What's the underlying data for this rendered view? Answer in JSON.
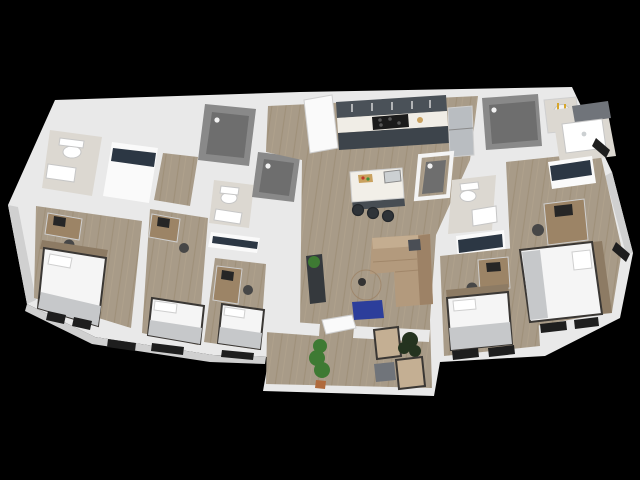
{
  "image": {
    "alt": "3D isometric rendering of a five bedroom, four bathroom apartment floor plan on a black background. Center has a kitchen with dark cabinets and an island with three stools, a living room with a tan sectional sofa, round coffee table and blue rug, and a lower entry lounge with two armchairs, an ottoman and plants. Left and right wings each hold bedrooms with beds and desks, bathrooms, walk-in showers and closets."
  },
  "scene": {
    "type": "3d-floorplan-rendering",
    "rooms": [
      "kitchen",
      "living-room",
      "entry-lounge",
      "bedroom-1",
      "bedroom-2",
      "bedroom-3",
      "bedroom-4",
      "bedroom-5",
      "bathroom-1",
      "bathroom-2",
      "bathroom-3",
      "bathroom-4",
      "shower-stalls",
      "closets",
      "laundry-water-heater"
    ],
    "furniture": [
      "bed-x5",
      "desk-x5",
      "desk-chair-x5",
      "sectional-sofa",
      "round-coffee-table",
      "media-console",
      "blue-rug",
      "kitchen-island",
      "bar-stool-x3",
      "refrigerator",
      "stove",
      "armchair-x2",
      "ottoman",
      "tall-plant",
      "dark-plant",
      "toilet-x3",
      "sink-x4",
      "water-heater"
    ]
  },
  "colors": {
    "background": "#000000",
    "wall": "#e9e9e9",
    "wall_shade": "#d0d0d0",
    "floor_wood": "#a89b88",
    "tile": "#dcd8d1",
    "shower_gray": "#898989",
    "shower_floor": "#6e6e6e",
    "cabinet_upper": "#4a5158",
    "cabinet_base": "#3d444b",
    "counter": "#f0ede6",
    "stove": "#1b1b1b",
    "burner": "#555555",
    "fridge": "#b9bdc1",
    "island_top": "#f2efe8",
    "island_base": "#474d53",
    "stool": "#2e3338",
    "sofa": "#b39a7d",
    "sofa_back": "#9d8266",
    "sofa_arm": "#c4ad90",
    "pillow_dark": "#4a4e55",
    "table": "#ab8c6a",
    "table_item": "#333333",
    "rug": "#2c3e9b",
    "console": "#35393d",
    "plant": "#3e7a33",
    "plant_dark": "#24331f",
    "pot": "#b06a3c",
    "armchair": "#c4af93",
    "armchair_frame": "#54422f",
    "ottoman": "#70747a",
    "bed": "#f5f5f5",
    "blanket": "#c6c8ca",
    "headboard": "#8d7b64",
    "desk": "#9c8466",
    "chair": "#474747",
    "monitor": "#262626",
    "clothes": "#2c3744",
    "window": "#1e1e1e",
    "door": "#fafafa",
    "fixture": "#ffffff",
    "heater": "#f2f2f2",
    "cutting_board": "#c9a15e",
    "board_red": "#c0392b",
    "board_green": "#3f8f3a",
    "sink_steel": "#ccd0d2"
  }
}
